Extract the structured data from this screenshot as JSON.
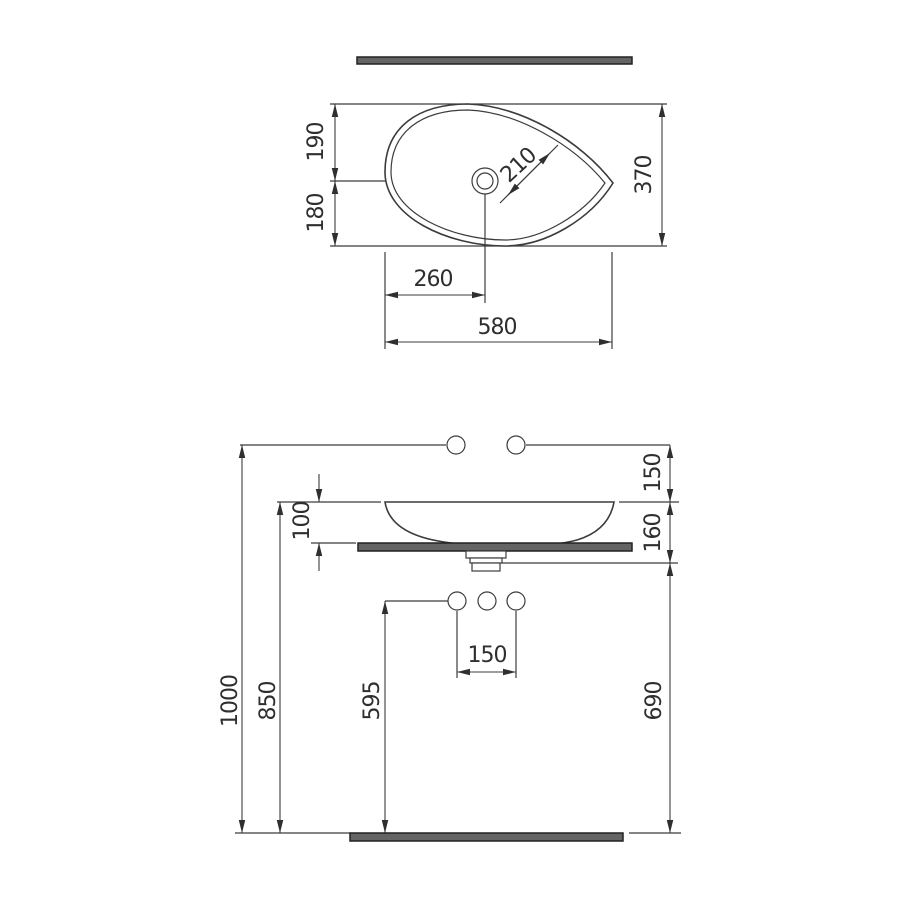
{
  "drawing": {
    "kind": "technical-dimension-drawing",
    "subject": "countertop washbasin with shelf",
    "units": "mm",
    "colors": {
      "line": "#3c3c3c",
      "text": "#2f2f2f",
      "bar_fill": "#646464",
      "bar_border": "#222222",
      "background": "#ffffff"
    },
    "top_view": {
      "dims": {
        "front_depth": "190",
        "back_depth": "180",
        "total_depth": "370",
        "drain_diagonal": "210",
        "drain_offset_x": "260",
        "total_width": "580"
      }
    },
    "front_view": {
      "dims": {
        "faucet_above_rim": "150",
        "basin_height": "100",
        "rim_to_trap": "160",
        "total_height": "1000",
        "rim_height": "850",
        "supply_height": "595",
        "outlet_height": "690",
        "supply_spacing": "150"
      }
    }
  }
}
